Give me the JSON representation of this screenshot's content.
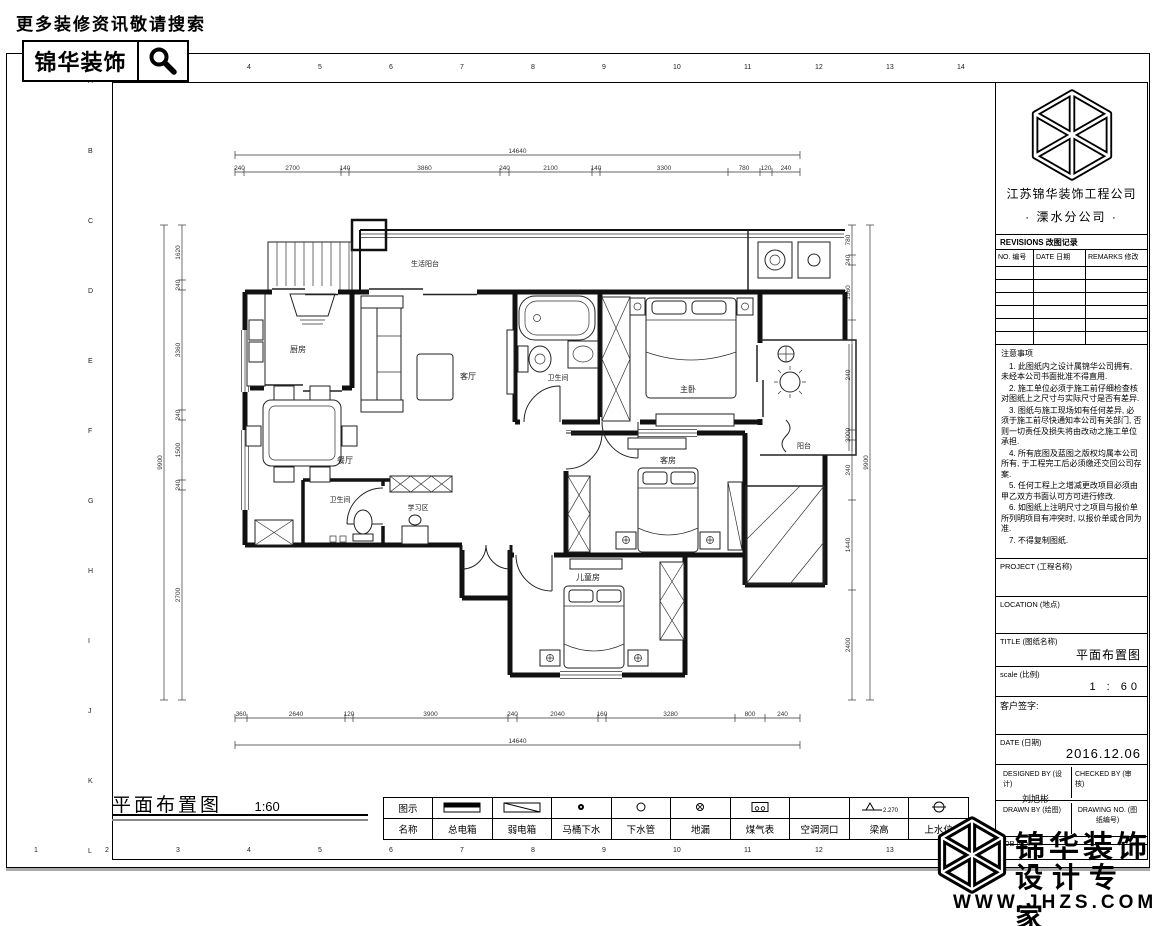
{
  "header": {
    "search_hint": "更多装修资讯敬请搜索",
    "brand": "锦华装饰"
  },
  "frame": {
    "columns": [
      "1",
      "2",
      "3",
      "4",
      "5",
      "6",
      "7",
      "8",
      "9",
      "10",
      "11",
      "12",
      "13",
      "14"
    ],
    "rows": [
      "A",
      "B",
      "C",
      "D",
      "E",
      "F",
      "G",
      "H",
      "I",
      "J",
      "K",
      "L"
    ]
  },
  "plan": {
    "title": "平面布置图",
    "scale": "1:60",
    "rooms": {
      "balcony_top": "生活阳台",
      "kitchen": "厨房",
      "dining": "餐厅",
      "living": "客厅",
      "bath_main": "卫生间",
      "master": "主卧",
      "balcony_right": "阳台",
      "guest": "客房",
      "study": "学习区",
      "bath_guest": "卫生间",
      "kids": "儿童房"
    },
    "dims": {
      "top_total": "14640",
      "top": [
        "240",
        "2700",
        "140",
        "3860",
        "240",
        "2100",
        "140",
        "3300",
        "780",
        "120",
        "240"
      ],
      "bottom": [
        "360",
        "2640",
        "120",
        "3900",
        "240",
        "2040",
        "160",
        "3280",
        "800",
        "240"
      ],
      "bottom_total": "14640",
      "left": [
        "1620",
        "240",
        "3360",
        "240",
        "1500",
        "240",
        "2700"
      ],
      "left_total": "9900",
      "right": [
        "780",
        "240",
        "1560",
        "240",
        "3000",
        "240",
        "1440",
        "2400"
      ],
      "right_total": "9900"
    }
  },
  "legend": {
    "col_symbol": "图示",
    "col_name": "名称",
    "items": [
      {
        "name": "总电箱"
      },
      {
        "name": "弱电箱"
      },
      {
        "name": "马桶下水"
      },
      {
        "name": "下水管"
      },
      {
        "name": "地漏"
      },
      {
        "name": "煤气表"
      },
      {
        "name": "空调洞口"
      },
      {
        "name": "梁高",
        "value": "2.270"
      },
      {
        "name": "上水位"
      }
    ]
  },
  "titleblock": {
    "company": "江苏锦华装饰工程公司",
    "branch": "· 溧水分公司 ·",
    "revisions": {
      "title": "REVISIONS 改图记录",
      "no": "NO. 编号",
      "date": "DATE 日期",
      "remarks": "REMARKS 修改"
    },
    "notes": {
      "title": "注意事项",
      "lines": [
        "1. 此图纸内之设计属锦华公司拥有, 未经本公司书面批准不得直用.",
        "2. 施工单位必须于施工前仔细检查核对图纸上之尺寸与实际尺寸是否有差异.",
        "3. 图纸与施工现场如有任何差异, 必须于施工前尽快通知本公司有关部门, 否则一切责任及损失将由改动之施工单位承担.",
        "4. 所有底图及蓝图之版权均属本公司所有, 于工程完工后必须缴还交回公司存案.",
        "5. 任何工程上之增减更改项目必须由甲乙双方书面认可方可进行修改.",
        "6. 如图纸上注明尺寸之项目与报价单所列明项目有冲突时, 以报价单或合同为准.",
        "7. 不得复制图纸."
      ]
    },
    "project_label": "PROJECT (工程名称)",
    "location_label": "LOCATION (地点)",
    "title_label": "TITLE (图纸名称)",
    "title_value": "平面布置图",
    "scale_label": "scale (比例)",
    "scale_value": "1 : 60",
    "sign_label": "客户签字:",
    "date_label": "DATE (日期)",
    "date_value": "2016.12.06",
    "designed_label": "DESIGNED BY (设计)",
    "designed_value": "刘旭彬",
    "checked_label": "CHECKED BY (审核)",
    "drawn_label": "DRAWN BY (绘图)",
    "drawing_no_label": "DRAWING NO. (图纸编号)",
    "job_label": "JOB NO."
  },
  "footer": {
    "brand_line1": "锦华装饰",
    "brand_line2": "设计专家",
    "url": "WWW.JHZS.COM"
  }
}
